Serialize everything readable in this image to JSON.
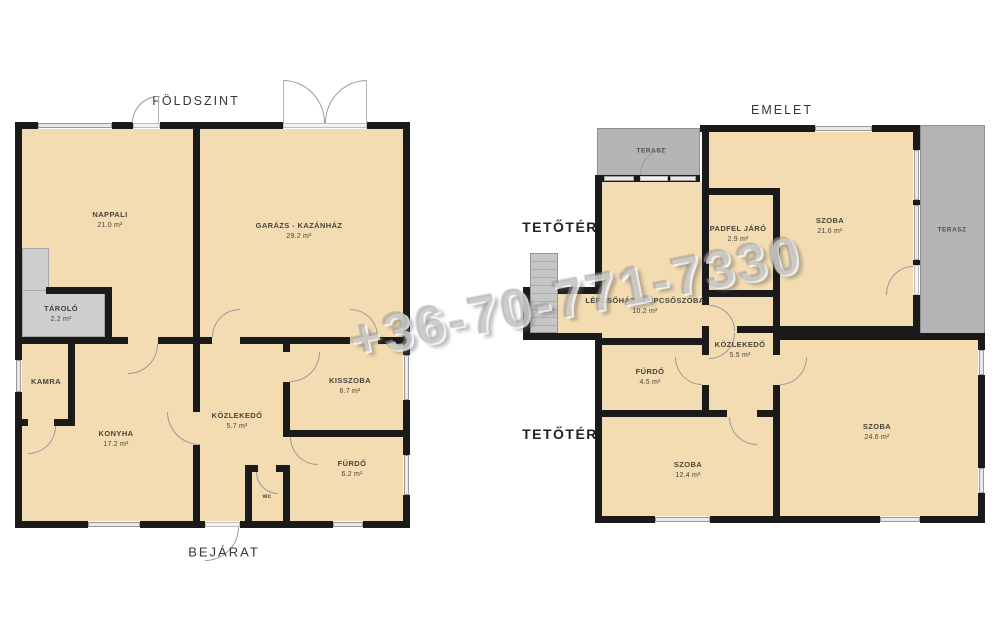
{
  "watermark": {
    "phone": "+36-70-771-7330"
  },
  "palette": {
    "floor_fill": "#f3dcb1",
    "wall": "#1a1a1a",
    "terrace_gray": "#b5b5b5",
    "storage_gray": "#cecece",
    "window_fill": "#e9e9e9"
  },
  "ground_floor": {
    "title": "FÖLDSZINT",
    "entrance_label": "BEJÁRAT",
    "rooms": [
      {
        "name": "NAPPALI",
        "area": "21.0 m²"
      },
      {
        "name": "GARÁZS - KAZÁNHÁZ",
        "area": "29.2 m²"
      },
      {
        "name": "TÁROLÓ",
        "area": "2.2 m²"
      },
      {
        "name": "KAMRA",
        "area": ""
      },
      {
        "name": "KONYHA",
        "area": "17.2 m²"
      },
      {
        "name": "KÖZLEKEDŐ",
        "area": "5.7 m²"
      },
      {
        "name": "KISSZOBA",
        "area": "6.7 m²"
      },
      {
        "name": "FÜRDŐ",
        "area": "6.2 m²"
      },
      {
        "name": "wc",
        "area": ""
      }
    ]
  },
  "upper_floor": {
    "title": "EMELET",
    "attic_label_top": "TETŐTÉR",
    "attic_label_bottom": "TETŐTÉR",
    "rooms": [
      {
        "name": "TERASZ",
        "area": ""
      },
      {
        "name": "SZOBA",
        "area": "21.6 m²"
      },
      {
        "name": "TERASZ",
        "area": ""
      },
      {
        "name": "PADFEL JÁRÓ",
        "area": "2.9 m²"
      },
      {
        "name": "LÉPCSŐHÁZ - LÉPCSŐSZOBA",
        "area": "10.2 m²"
      },
      {
        "name": "KÖZLEKEDŐ",
        "area": "5.5 m²"
      },
      {
        "name": "FÜRDŐ",
        "area": "4.5 m²"
      },
      {
        "name": "SZOBA",
        "area": "12.4 m²"
      },
      {
        "name": "SZOBA",
        "area": "24.6 m²"
      }
    ]
  }
}
